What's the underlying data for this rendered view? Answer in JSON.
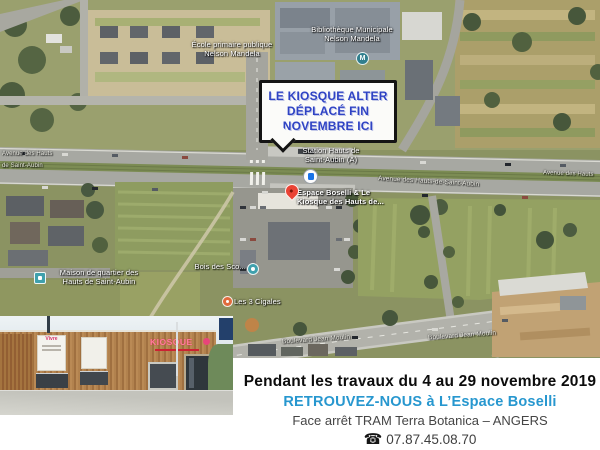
{
  "callout": {
    "text": "LE KIOSQUE ALTER\nDÉPLACÉ FIN\nNOVEMBRE ICI"
  },
  "map": {
    "labels": {
      "school": "École primaire publique\nNelson Mandela",
      "library": "Bibliothèque Municipale\nNelson Mandela",
      "library_marker": "M",
      "station": "Station Hauts de\nSaint-Aubin (A)",
      "avenue_center": "Avenue des Hauts-de-Saint-Aubin",
      "avenue_left_1": "Avenue des Hauts",
      "avenue_left_2": "de Saint-Aubin",
      "avenue_right": "Avenue des Hauts",
      "espace_boselli": "Espace Boselli & Le\nKiosque des Hauts de...",
      "maison_quartier": "Maison de quartier des\nHauts de Saint-Aubin",
      "bois": "Bois des Sco...",
      "cigales": "Les 3 Cigales",
      "boulevard_1": "Boulevard Jean Moulin",
      "boulevard_2": "Boulevard Jean Moulin"
    }
  },
  "photo": {
    "sign": "KIOSQUE",
    "panel_text": "Vivre"
  },
  "footer": {
    "line1": "Pendant les travaux du 4 au 29 novembre 2019",
    "line2": "RETROUVEZ-NOUS à L’Espace Boselli",
    "line3": "Face arrêt TRAM Terra Botanica – ANGERS",
    "phone_icon": "☎",
    "phone": "07.87.45.08.70"
  },
  "colors": {
    "accent_blue": "#2797cf",
    "callout_blue": "#2f43c4",
    "pin_red": "#ea4335",
    "poi_teal": "#3fa0ad"
  }
}
